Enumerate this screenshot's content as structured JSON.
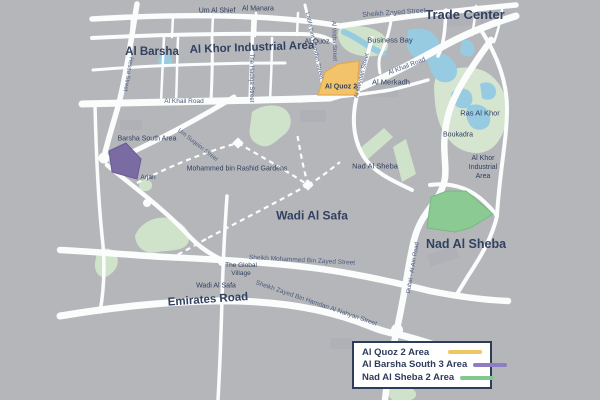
{
  "colors": {
    "background": "#b4b6ba",
    "road": "#fbfcfc",
    "label": "#32415f",
    "street_label": "#4d5c7e",
    "park": "#cfe2ca",
    "wetland": "#d5e5cf",
    "water": "#97cbe2",
    "building": "#a8abb1",
    "quoz_fill": "#f3c36a",
    "quoz_stroke": "#e3a94f",
    "barsha_fill": "#7b6ba3",
    "barsha_stroke": "#6a5a94",
    "sheba_fill": "#8bcb93",
    "sheba_stroke": "#73bb7e",
    "legend_border": "#2e3c5c",
    "legend_text": "#2e3c5c"
  },
  "map": {
    "labels": {
      "um_al_shief": "Um Al Shief",
      "al_manara": "Al Manara",
      "sheikh_zayed_street": "Sheikh Zayed Street",
      "trade_center": "Trade Center",
      "al_khor_industrial_area_nw": "Al Khor Industrial Area",
      "al_quoz": "Al Quoz",
      "business_bay": "Business Bay",
      "latifa_bint_hamdan_street": "Latifa bint Hamdan Street",
      "al_waha_street": "Al Waha Street",
      "the_hadiqa_street": "The Hadiqa Street",
      "hessa_street": "Hessa Street",
      "al_barsha": "Al Barsha",
      "al_khail_road_w": "Al Khail Road",
      "al_khail_road_e": "Al Khail Road",
      "al_meydan_street": "Al Meydan Street",
      "al_quoz_2": "Al Quoz 2",
      "al_merkadh": "Al Merkadh",
      "ras_al_khor": "Ras Al Khor",
      "boukadra": "Boukadra",
      "al_khor_industrial_area_e": "Al Khor\nIndustrial\nArea",
      "nad_al_sheba_meydan": "Nad Al Sheba",
      "barsha_south_area": "Barsha South Area",
      "arjan": "Arjan",
      "mohammed_bin_rashid_gardens": "Mohammed bin Rashid Gardens",
      "um_suqeim_street": "Um Suqeim Street",
      "wadi_al_safa_big": "Wadi Al Safa",
      "nad_al_sheba_big": "Nad Al Sheba",
      "dubai_al_ain_road": "Dubai - Al Ain Road",
      "sheikh_mohammed_bin_zayed_street": "Sheikh Mohammed Bin Zayed Street",
      "the_global_village": "The Global\nVillage",
      "wadi_al_safa_small": "Wadi Al Safa",
      "emirates_road": "Emirates Road",
      "sheikh_zayed_bin_hamdan": "Sheikh Zayed Bin Hamdan Al Nahyan Street"
    }
  },
  "legend": {
    "items": [
      {
        "label": "Al Quoz 2 Area",
        "color": "#eec763"
      },
      {
        "label": "Al Barsha South 3 Area",
        "color": "#8d7dc3"
      },
      {
        "label": "Nad Al Sheba 2 Area",
        "color": "#7fc98c"
      }
    ]
  }
}
